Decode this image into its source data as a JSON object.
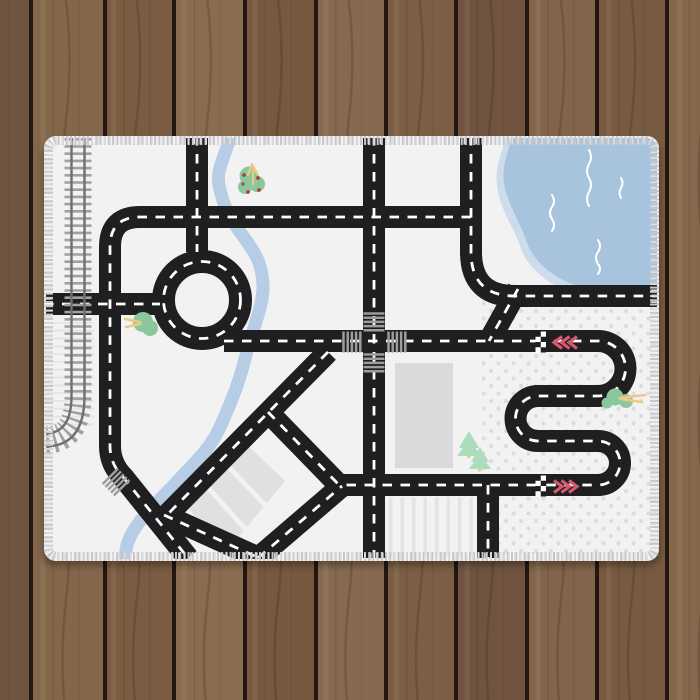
{
  "scene": {
    "description": "Product photo of a children's city road play mat rug lying on a dark wooden plank floor",
    "mat_motifs": [
      "railroad-track",
      "roundabout",
      "river",
      "lake",
      "four-way-crosswalk-intersection",
      "race-s-curve-with-start-finish-lines",
      "parking-lot",
      "buildings",
      "pine-trees",
      "bushes",
      "polka-dot-field",
      "striped-fields"
    ]
  },
  "colors": {
    "road": "#1f1f21",
    "road_dash": "#ffffff",
    "mat_bg": "#f2f2f3",
    "stitch": "#c7c7c9",
    "stitch_light": "#dfdfe1",
    "river": "#b7cde5",
    "lake": "#a8c3de",
    "lake_shore": "#cddcec",
    "squiggle": "#ffffff",
    "dot": "#dcdcde",
    "field_stripe": "#e4e4e6",
    "building": "#dadadc",
    "parking": "#e0e0e2",
    "parking_stripe": "#f2f2f3",
    "crosswalk": "#9e9ea1",
    "rail_tie": "#a0a0a3",
    "rail": "#6f6f72",
    "bush_green": "#8bc79d",
    "pine_green": "#abdcbb",
    "trunk_yellow": "#edc985",
    "berry_red": "#b0403c",
    "chevron_red": "#d8586e",
    "checker_white": "#ffffff",
    "checker_black": "#1f1f21",
    "wood_gap": "#221711",
    "wood_grain": "#2a1a0e"
  },
  "wood": {
    "plank_colors": [
      "#6f5440",
      "#84674b",
      "#7a5c42",
      "#8a6c50",
      "#76593f",
      "#866950",
      "#7b5e44",
      "#715440",
      "#82644a",
      "#775a41",
      "#85674c"
    ],
    "gap_xs": [
      31,
      105,
      174,
      245,
      316,
      386,
      456,
      527,
      597,
      667
    ]
  }
}
